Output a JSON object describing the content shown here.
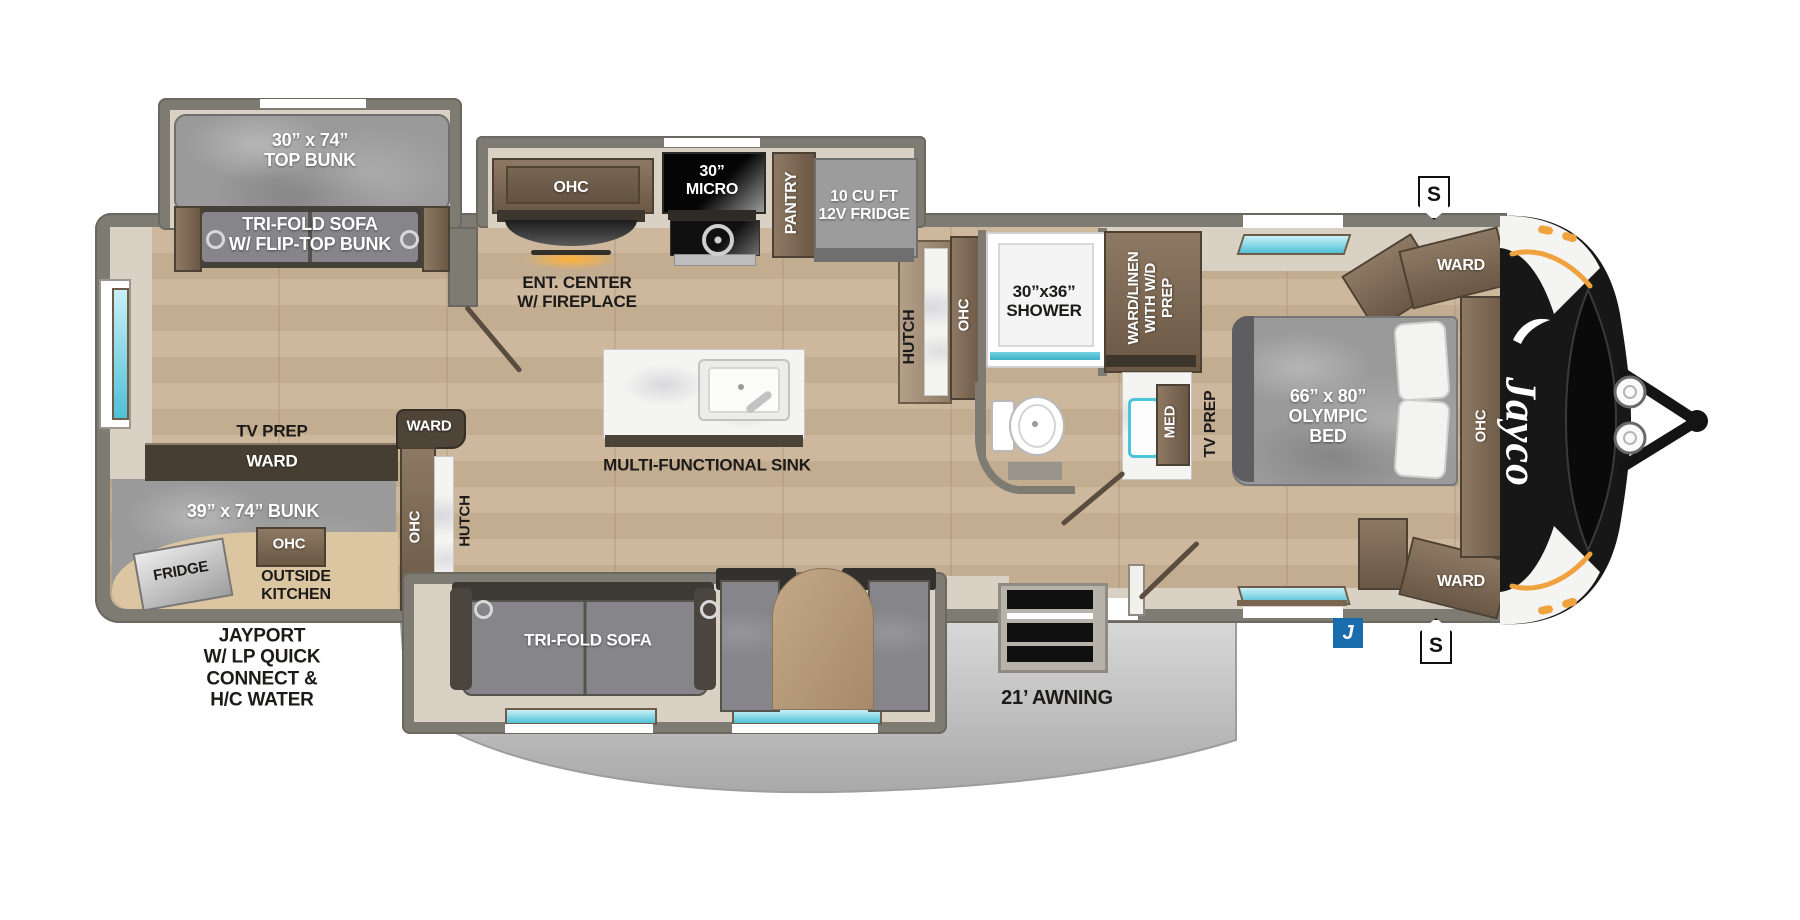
{
  "title": "Jayco travel trailer floor plan",
  "colors": {
    "accent_orange": "#f0a23e",
    "badge_blue": "#1a6dad",
    "window_teal": "#4fc0d6",
    "awning_gray": "#c9c9c9",
    "wall_gray": "#7e7b73",
    "floor_wood": "#c9b499"
  },
  "brand": {
    "logo": "Jayco"
  },
  "badges": {
    "s_top": "S",
    "s_bottom": "S",
    "j": "J"
  },
  "labels": {
    "top_bunk": "30” x 74”\nTOP BUNK",
    "trifold_bunk_sofa": "TRI-FOLD SOFA\nW/ FLIP-TOP BUNK",
    "ent_ohc": "OHC",
    "ent_center": "ENT. CENTER\nW/ FIREPLACE",
    "micro": "30”\nMICRO",
    "pantry": "PANTRY",
    "fridge_12v": "10 CU FT\n12V FRIDGE",
    "hutch_main": "HUTCH",
    "bath_ohc": "OHC",
    "shower": "30”x36”\nSHOWER",
    "ward_linen": "WARD/LINEN\nWITH W/D\nPREP",
    "med": "MED",
    "tv_prep_bedroom": "TV PREP",
    "bed": "66” x 80”\nOLYMPIC\nBED",
    "ward_bed_top": "WARD",
    "bed_ohc": "OHC",
    "ward_bed_bottom": "WARD",
    "tv_prep_rear": "TV PREP",
    "ward_rear": "WARD",
    "bunk39": "39” x 74” BUNK",
    "outside_fridge": "FRIDGE",
    "outside_ohc": "OHC",
    "outside_kitchen": "OUTSIDE\nKITCHEN",
    "ward_corner": "WARD",
    "corner_ohc": "OHC",
    "hutch_rear": "HUTCH",
    "jayport": "JAYPORT\nW/ LP QUICK\nCONNECT &\nH/C WATER",
    "trifold_sofa": "TRI-FOLD SOFA",
    "sink": "MULTI-FUNCTIONAL SINK",
    "awning": "21’ AWNING"
  }
}
